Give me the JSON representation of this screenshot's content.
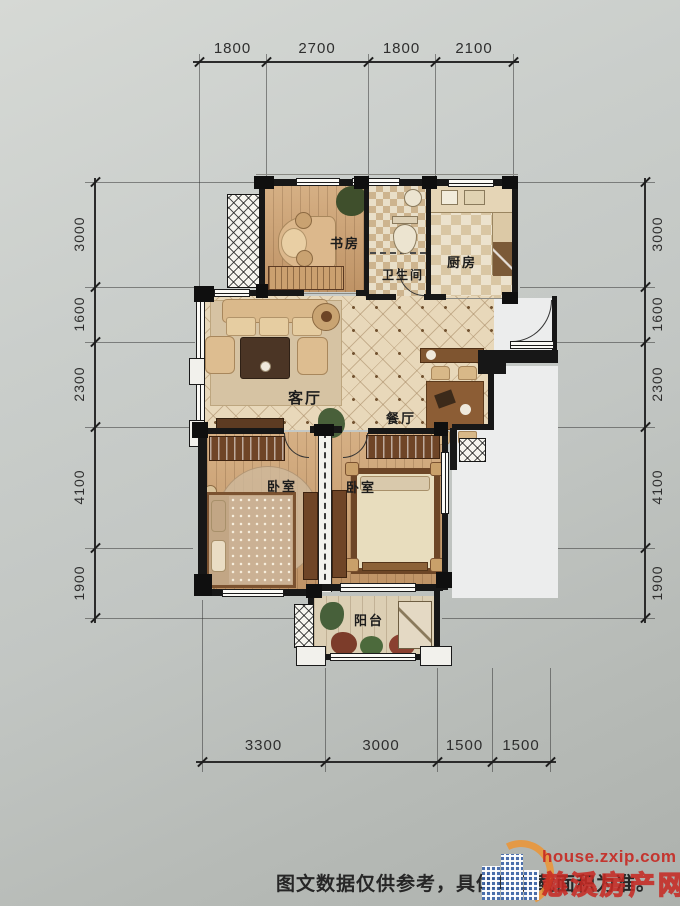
{
  "dimensions": {
    "top": [
      "1800",
      "2700",
      "1800",
      "2100"
    ],
    "bottom": [
      "3300",
      "3000",
      "1500",
      "1500"
    ],
    "left": [
      "3000",
      "1600",
      "2300",
      "4100",
      "1900"
    ],
    "right": [
      "3000",
      "1600",
      "2300",
      "4100",
      "1900"
    ]
  },
  "rooms": {
    "study": "书房",
    "bathroom": "卫生间",
    "kitchen": "厨房",
    "living_room": "客厅",
    "dining_room": "餐厅",
    "bedroom_left": "卧室",
    "bedroom_right": "卧室",
    "balcony": "阳台"
  },
  "caption": "图文数据仅供参考，具体以证载面积为准。",
  "watermark": {
    "url": "house.zxip.com",
    "site": "慈溪房产网"
  },
  "colors": {
    "wall": "#171717",
    "wood_floor": "#c89c6e",
    "tile_floor": "#e8d8ba",
    "watermark_red": "#c62a24",
    "logo_blue": "#3762aa",
    "logo_orange": "#eb9637"
  }
}
